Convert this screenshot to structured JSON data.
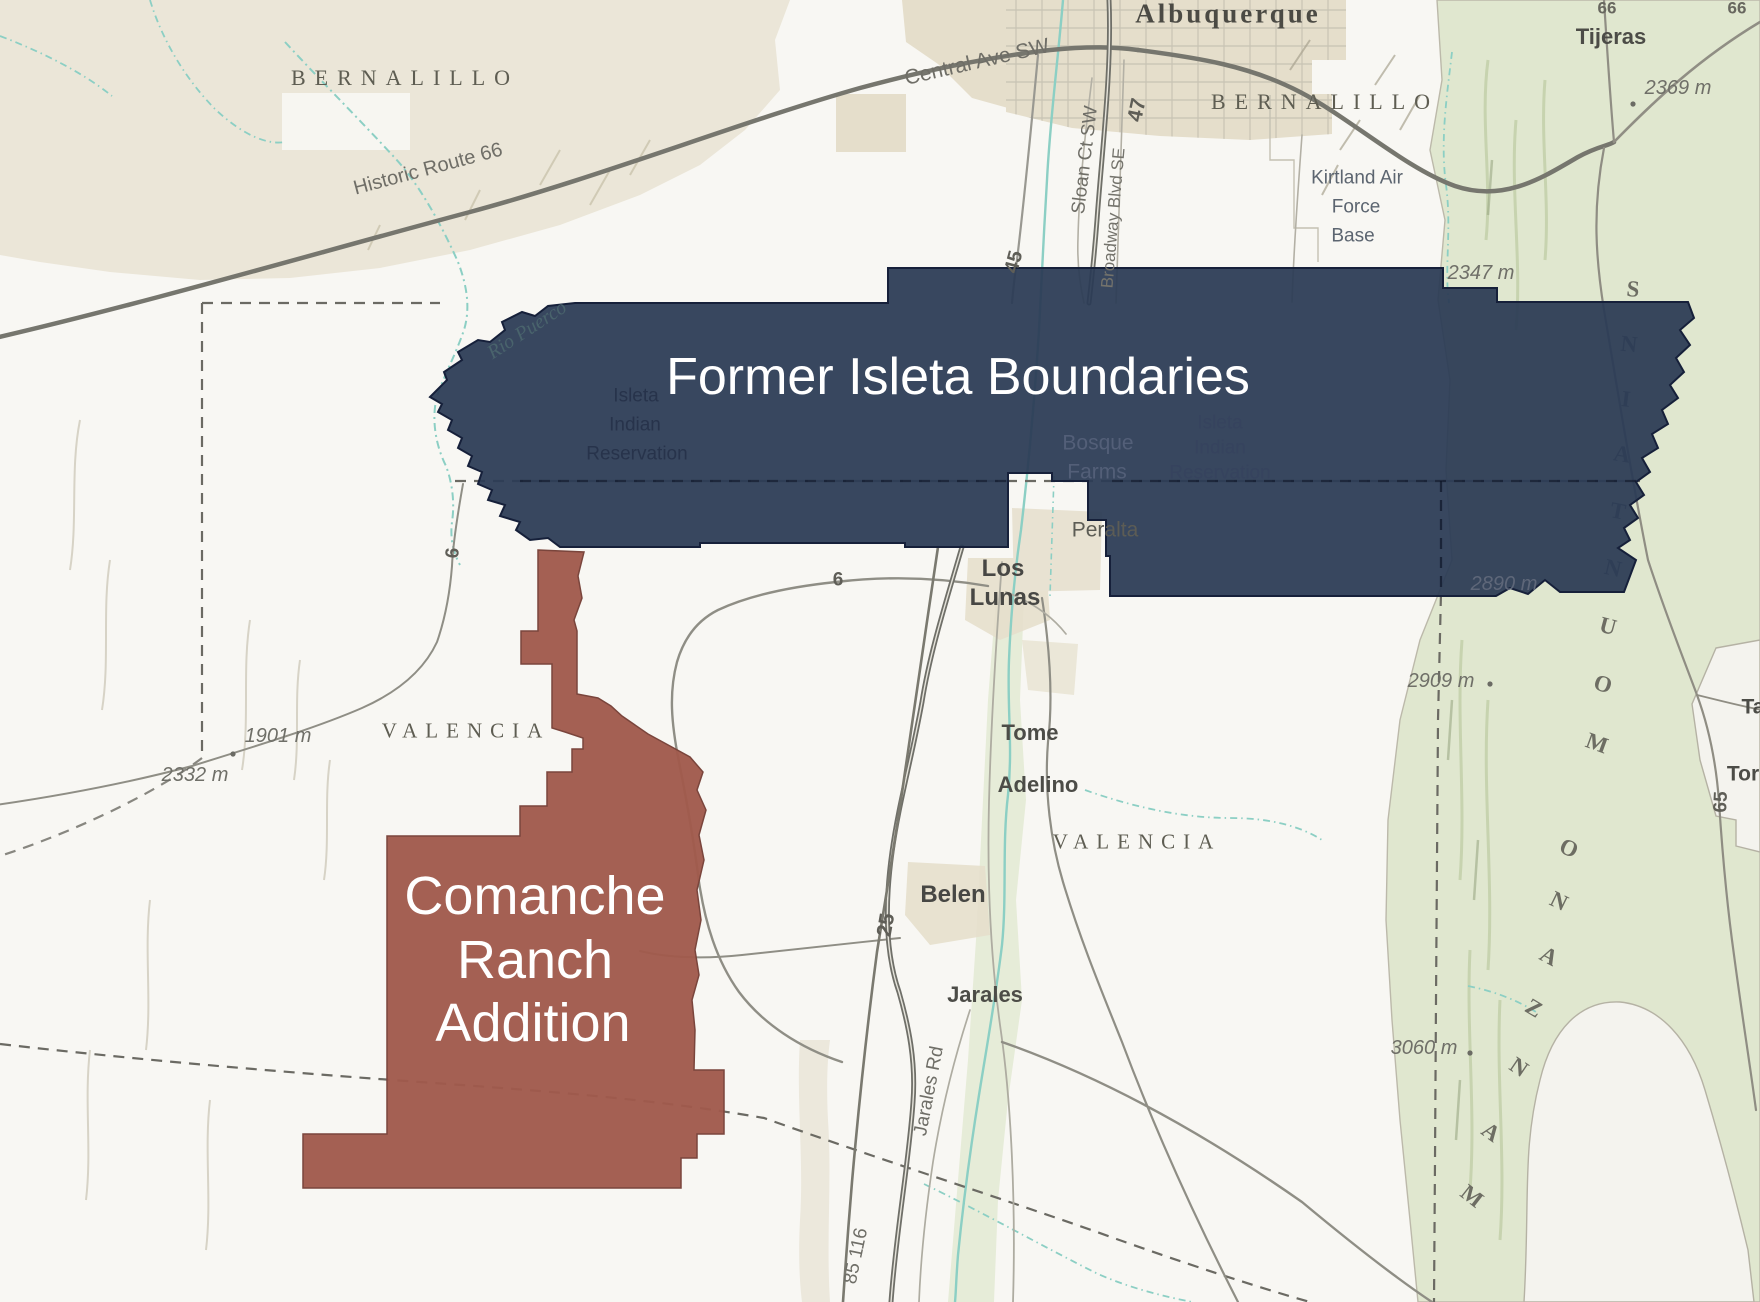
{
  "overlays": {
    "former_isleta": {
      "label": "Former Isleta Boundaries",
      "fill": "#2c3b55",
      "outline": "#16203a"
    },
    "comanche_ranch": {
      "label": "Comanche Ranch Addition",
      "fill": "#a0594c",
      "outline": "#7a453c"
    }
  },
  "basemap_colors": {
    "terrain_beige": "#ebe6d8",
    "mountain_green": "#e0e7cf",
    "water_teal": "#8ccfc4",
    "major_road_gray": "#6f6f68",
    "county_dash_gray": "#6b6a63",
    "urban_tan": "#e5decb"
  },
  "labels": {
    "under": [
      {
        "name": "manzano-letter-m1",
        "text": "M",
        "x": 1472,
        "y": 1196,
        "fs": 23,
        "color": "#6d6d63",
        "serif": true,
        "w": 600,
        "rot": 38
      },
      {
        "name": "manzano-letter-a1",
        "text": "A",
        "x": 1491,
        "y": 1132,
        "fs": 23,
        "color": "#6d6d63",
        "serif": true,
        "w": 600,
        "rot": 36
      },
      {
        "name": "manzano-letter-n1",
        "text": "N",
        "x": 1519,
        "y": 1067,
        "fs": 23,
        "color": "#6d6d63",
        "serif": true,
        "w": 600,
        "rot": 34
      },
      {
        "name": "manzano-letter-z",
        "text": "Z",
        "x": 1534,
        "y": 1008,
        "fs": 23,
        "color": "#6d6d63",
        "serif": true,
        "w": 600,
        "rot": 31
      },
      {
        "name": "manzano-letter-a2",
        "text": "A",
        "x": 1549,
        "y": 956,
        "fs": 23,
        "color": "#6d6d63",
        "serif": true,
        "w": 600,
        "rot": 28
      },
      {
        "name": "manzano-letter-n2",
        "text": "N",
        "x": 1559,
        "y": 901,
        "fs": 23,
        "color": "#6d6d63",
        "serif": true,
        "w": 600,
        "rot": 26
      },
      {
        "name": "manzano-letter-o1",
        "text": "O",
        "x": 1569,
        "y": 848,
        "fs": 23,
        "color": "#6d6d63",
        "serif": true,
        "w": 600,
        "rot": 24
      },
      {
        "name": "mountains-letter-m",
        "text": "M",
        "x": 1597,
        "y": 743,
        "fs": 23,
        "color": "#6d6d63",
        "serif": true,
        "w": 600,
        "rot": 20
      },
      {
        "name": "mountains-letter-o",
        "text": "O",
        "x": 1603,
        "y": 684,
        "fs": 23,
        "color": "#6d6d63",
        "serif": true,
        "w": 600,
        "rot": 17
      },
      {
        "name": "mountains-letter-u",
        "text": "U",
        "x": 1608,
        "y": 626,
        "fs": 23,
        "color": "#6d6d63",
        "serif": true,
        "w": 600,
        "rot": 15
      },
      {
        "name": "mountains-letter-n1",
        "text": "N",
        "x": 1613,
        "y": 568,
        "fs": 23,
        "color": "#6d6d63",
        "serif": true,
        "w": 600,
        "rot": 13
      },
      {
        "name": "mountains-letter-t",
        "text": "T",
        "x": 1618,
        "y": 511,
        "fs": 23,
        "color": "#6d6d63",
        "serif": true,
        "w": 600,
        "rot": 11
      },
      {
        "name": "mountains-letter-a",
        "text": "A",
        "x": 1622,
        "y": 454,
        "fs": 23,
        "color": "#6d6d63",
        "serif": true,
        "w": 600,
        "rot": 9
      },
      {
        "name": "mountains-letter-i",
        "text": "I",
        "x": 1626,
        "y": 399,
        "fs": 23,
        "color": "#6d6d63",
        "serif": true,
        "w": 600,
        "rot": 7
      },
      {
        "name": "mountains-letter-n2",
        "text": "N",
        "x": 1629,
        "y": 344,
        "fs": 23,
        "color": "#6d6d63",
        "serif": true,
        "w": 600,
        "rot": 6
      },
      {
        "name": "mountains-letter-s",
        "text": "S",
        "x": 1633,
        "y": 289,
        "fs": 23,
        "color": "#6d6d63",
        "serif": true,
        "w": 600,
        "rot": 5
      }
    ],
    "top": [
      {
        "name": "city-albuquerque",
        "text": "Albuquerque",
        "x": 1228,
        "y": 14,
        "fs": 27,
        "color": "#4b4a44",
        "serif": true,
        "w": 600,
        "ls": 3
      },
      {
        "name": "county-bernalillo-ne",
        "text": "BERNALILLO",
        "x": 1325,
        "y": 102,
        "fs": 22,
        "color": "#5e5d52",
        "serif": true,
        "ls": 9
      },
      {
        "name": "county-bernalillo-nw",
        "text": "BERNALILLO",
        "x": 405,
        "y": 78,
        "fs": 22,
        "color": "#5e5d52",
        "serif": true,
        "ls": 9
      },
      {
        "name": "town-tijeras",
        "text": "Tijeras",
        "x": 1611,
        "y": 37,
        "fs": 22,
        "color": "#4c4c47",
        "w": 600
      },
      {
        "name": "elev-2369",
        "text": "2369 m",
        "x": 1678,
        "y": 88,
        "fs": 20,
        "color": "#6f6f68",
        "italic": true
      },
      {
        "name": "route-66-north",
        "text": "66",
        "x": 1607,
        "y": 8,
        "fs": 17,
        "color": "#68675f",
        "w": 600
      },
      {
        "name": "route-66-corner",
        "text": "66",
        "x": 1737,
        "y": 8,
        "fs": 17,
        "color": "#68675f",
        "w": 600
      },
      {
        "name": "kirtland-line1",
        "text": "Kirtland Air",
        "x": 1357,
        "y": 178,
        "fs": 19,
        "color": "#5c6570"
      },
      {
        "name": "kirtland-line2",
        "text": "Force",
        "x": 1356,
        "y": 207,
        "fs": 19,
        "color": "#5c6570"
      },
      {
        "name": "kirtland-line3",
        "text": "Base",
        "x": 1353,
        "y": 236,
        "fs": 19,
        "color": "#5c6570"
      },
      {
        "name": "elev-2347",
        "text": "2347 m",
        "x": 1481,
        "y": 273,
        "fs": 20,
        "color": "#6f6f68",
        "italic": true
      },
      {
        "name": "road-central-ave",
        "text": "Central Ave SW",
        "x": 977,
        "y": 62,
        "fs": 21,
        "color": "#6f6e67",
        "rot": -13
      },
      {
        "name": "road-sloan-ct",
        "text": "Sloan Ct SW",
        "x": 1085,
        "y": 160,
        "fs": 19,
        "color": "#6f6e67",
        "rot": -83
      },
      {
        "name": "route-47",
        "text": "47",
        "x": 1137,
        "y": 110,
        "fs": 21,
        "color": "#5f5e57",
        "w": 600,
        "rot": -78
      },
      {
        "name": "road-broadway-blvd",
        "text": "Broadway Blvd SE",
        "x": 1113,
        "y": 218,
        "fs": 17,
        "color": "#74736c",
        "rot": -85
      },
      {
        "name": "route-45",
        "text": "45",
        "x": 1014,
        "y": 262,
        "fs": 20,
        "color": "#5f5e57",
        "w": 600,
        "rot": -75
      },
      {
        "name": "road-historic-route-66",
        "text": "Historic Route 66",
        "x": 428,
        "y": 169,
        "fs": 20,
        "color": "#6f6e67",
        "rot": -15
      },
      {
        "name": "river-rio-puerco",
        "text": "Rio Puerco",
        "x": 527,
        "y": 330,
        "fs": 20,
        "color": "#49636c",
        "serif": true,
        "italic": true,
        "rot": -33
      },
      {
        "name": "overlay-title-former-isleta",
        "text": "Former Isleta Boundaries",
        "x": 958,
        "y": 377,
        "fs": 52,
        "color": "#ffffff"
      },
      {
        "name": "reservation-west-line1",
        "text": "Isleta",
        "x": 636,
        "y": 396,
        "fs": 19,
        "color": "#27334b"
      },
      {
        "name": "reservation-west-line2",
        "text": "Indian",
        "x": 635,
        "y": 425,
        "fs": 19,
        "color": "#27334b"
      },
      {
        "name": "reservation-west-line3",
        "text": "Reservation",
        "x": 637,
        "y": 454,
        "fs": 19,
        "color": "#27334b"
      },
      {
        "name": "reservation-east-line1",
        "text": "Isleta",
        "x": 1220,
        "y": 423,
        "fs": 19,
        "color": "#36435e"
      },
      {
        "name": "reservation-east-line2",
        "text": "Indian",
        "x": 1220,
        "y": 448,
        "fs": 19,
        "color": "#36435e"
      },
      {
        "name": "reservation-east-line3",
        "text": "Reservation",
        "x": 1220,
        "y": 473,
        "fs": 19,
        "color": "#36435e"
      },
      {
        "name": "town-bosque-farms-line1",
        "text": "Bosque",
        "x": 1098,
        "y": 443,
        "fs": 21,
        "color": "#535f78"
      },
      {
        "name": "town-bosque-farms-line2",
        "text": "Farms",
        "x": 1097,
        "y": 472,
        "fs": 21,
        "color": "#535f78"
      },
      {
        "name": "town-peralta",
        "text": "Peralta",
        "x": 1105,
        "y": 530,
        "fs": 21,
        "color": "#5c5c55"
      },
      {
        "name": "elev-2890",
        "text": "2890 m",
        "x": 1504,
        "y": 584,
        "fs": 20,
        "color": "#5e6779",
        "italic": true
      },
      {
        "name": "town-los-lunas-line1",
        "text": "Los",
        "x": 1003,
        "y": 569,
        "fs": 24,
        "color": "#474744",
        "w": 600
      },
      {
        "name": "town-los-lunas-line2",
        "text": "Lunas",
        "x": 1005,
        "y": 598,
        "fs": 24,
        "color": "#474744",
        "w": 600
      },
      {
        "name": "route-6-west",
        "text": "6",
        "x": 838,
        "y": 580,
        "fs": 19,
        "color": "#5f5e57",
        "w": 600
      },
      {
        "name": "route-6-left",
        "text": "6",
        "x": 453,
        "y": 553,
        "fs": 19,
        "color": "#5f5e57",
        "w": 600,
        "rot": -85
      },
      {
        "name": "elev-2909",
        "text": "2909 m",
        "x": 1441,
        "y": 681,
        "fs": 20,
        "color": "#6f6f68",
        "italic": true
      },
      {
        "name": "town-tome",
        "text": "Tome",
        "x": 1030,
        "y": 733,
        "fs": 22,
        "color": "#4c4c47",
        "w": 600
      },
      {
        "name": "town-adelino",
        "text": "Adelino",
        "x": 1038,
        "y": 785,
        "fs": 22,
        "color": "#4c4c47",
        "w": 600
      },
      {
        "name": "county-valencia-east",
        "text": "VALENCIA",
        "x": 1137,
        "y": 842,
        "fs": 21,
        "color": "#5e5d52",
        "serif": true,
        "ls": 8
      },
      {
        "name": "county-valencia-west",
        "text": "VALENCIA",
        "x": 466,
        "y": 731,
        "fs": 21,
        "color": "#5e5d52",
        "serif": true,
        "ls": 8
      },
      {
        "name": "elev-1901",
        "text": "1901 m",
        "x": 278,
        "y": 736,
        "fs": 20,
        "color": "#6f6f68",
        "italic": true
      },
      {
        "name": "elev-2332",
        "text": "2332 m",
        "x": 195,
        "y": 775,
        "fs": 20,
        "color": "#6f6f68",
        "italic": true
      },
      {
        "name": "town-belen",
        "text": "Belen",
        "x": 953,
        "y": 895,
        "fs": 24,
        "color": "#474744",
        "w": 600
      },
      {
        "name": "route-25",
        "text": "25",
        "x": 886,
        "y": 925,
        "fs": 21,
        "color": "#5f5e57",
        "w": 600,
        "rot": -80
      },
      {
        "name": "town-jarales",
        "text": "Jarales",
        "x": 985,
        "y": 995,
        "fs": 22,
        "color": "#4c4c47",
        "w": 600
      },
      {
        "name": "road-jarales-rd",
        "text": "Jarales Rd",
        "x": 929,
        "y": 1091,
        "fs": 19,
        "color": "#6f6e67",
        "rot": -79
      },
      {
        "name": "route-85-116",
        "text": "85 116",
        "x": 856,
        "y": 1256,
        "fs": 19,
        "color": "#6f6e67",
        "rot": -78
      },
      {
        "name": "elev-3060",
        "text": "3060 m",
        "x": 1424,
        "y": 1048,
        "fs": 20,
        "color": "#6f6f68",
        "italic": true
      },
      {
        "name": "route-65",
        "text": "65",
        "x": 1721,
        "y": 802,
        "fs": 19,
        "color": "#5f5e57",
        "w": 600,
        "rot": -87
      },
      {
        "name": "town-ta-clipped",
        "text": "Ta",
        "x": 1753,
        "y": 707,
        "fs": 21,
        "color": "#4c4c47",
        "w": 600
      },
      {
        "name": "town-tor-clipped",
        "text": "Tor",
        "x": 1743,
        "y": 774,
        "fs": 21,
        "color": "#4c4c47",
        "w": 600
      },
      {
        "name": "overlay-title-comanche-line1",
        "text": "Comanche",
        "x": 535,
        "y": 896,
        "fs": 54,
        "color": "#ffffff"
      },
      {
        "name": "overlay-title-comanche-line2",
        "text": "Ranch",
        "x": 535,
        "y": 960,
        "fs": 54,
        "color": "#ffffff"
      },
      {
        "name": "overlay-title-comanche-line3",
        "text": "Addition",
        "x": 533,
        "y": 1023,
        "fs": 54,
        "color": "#ffffff"
      }
    ]
  }
}
